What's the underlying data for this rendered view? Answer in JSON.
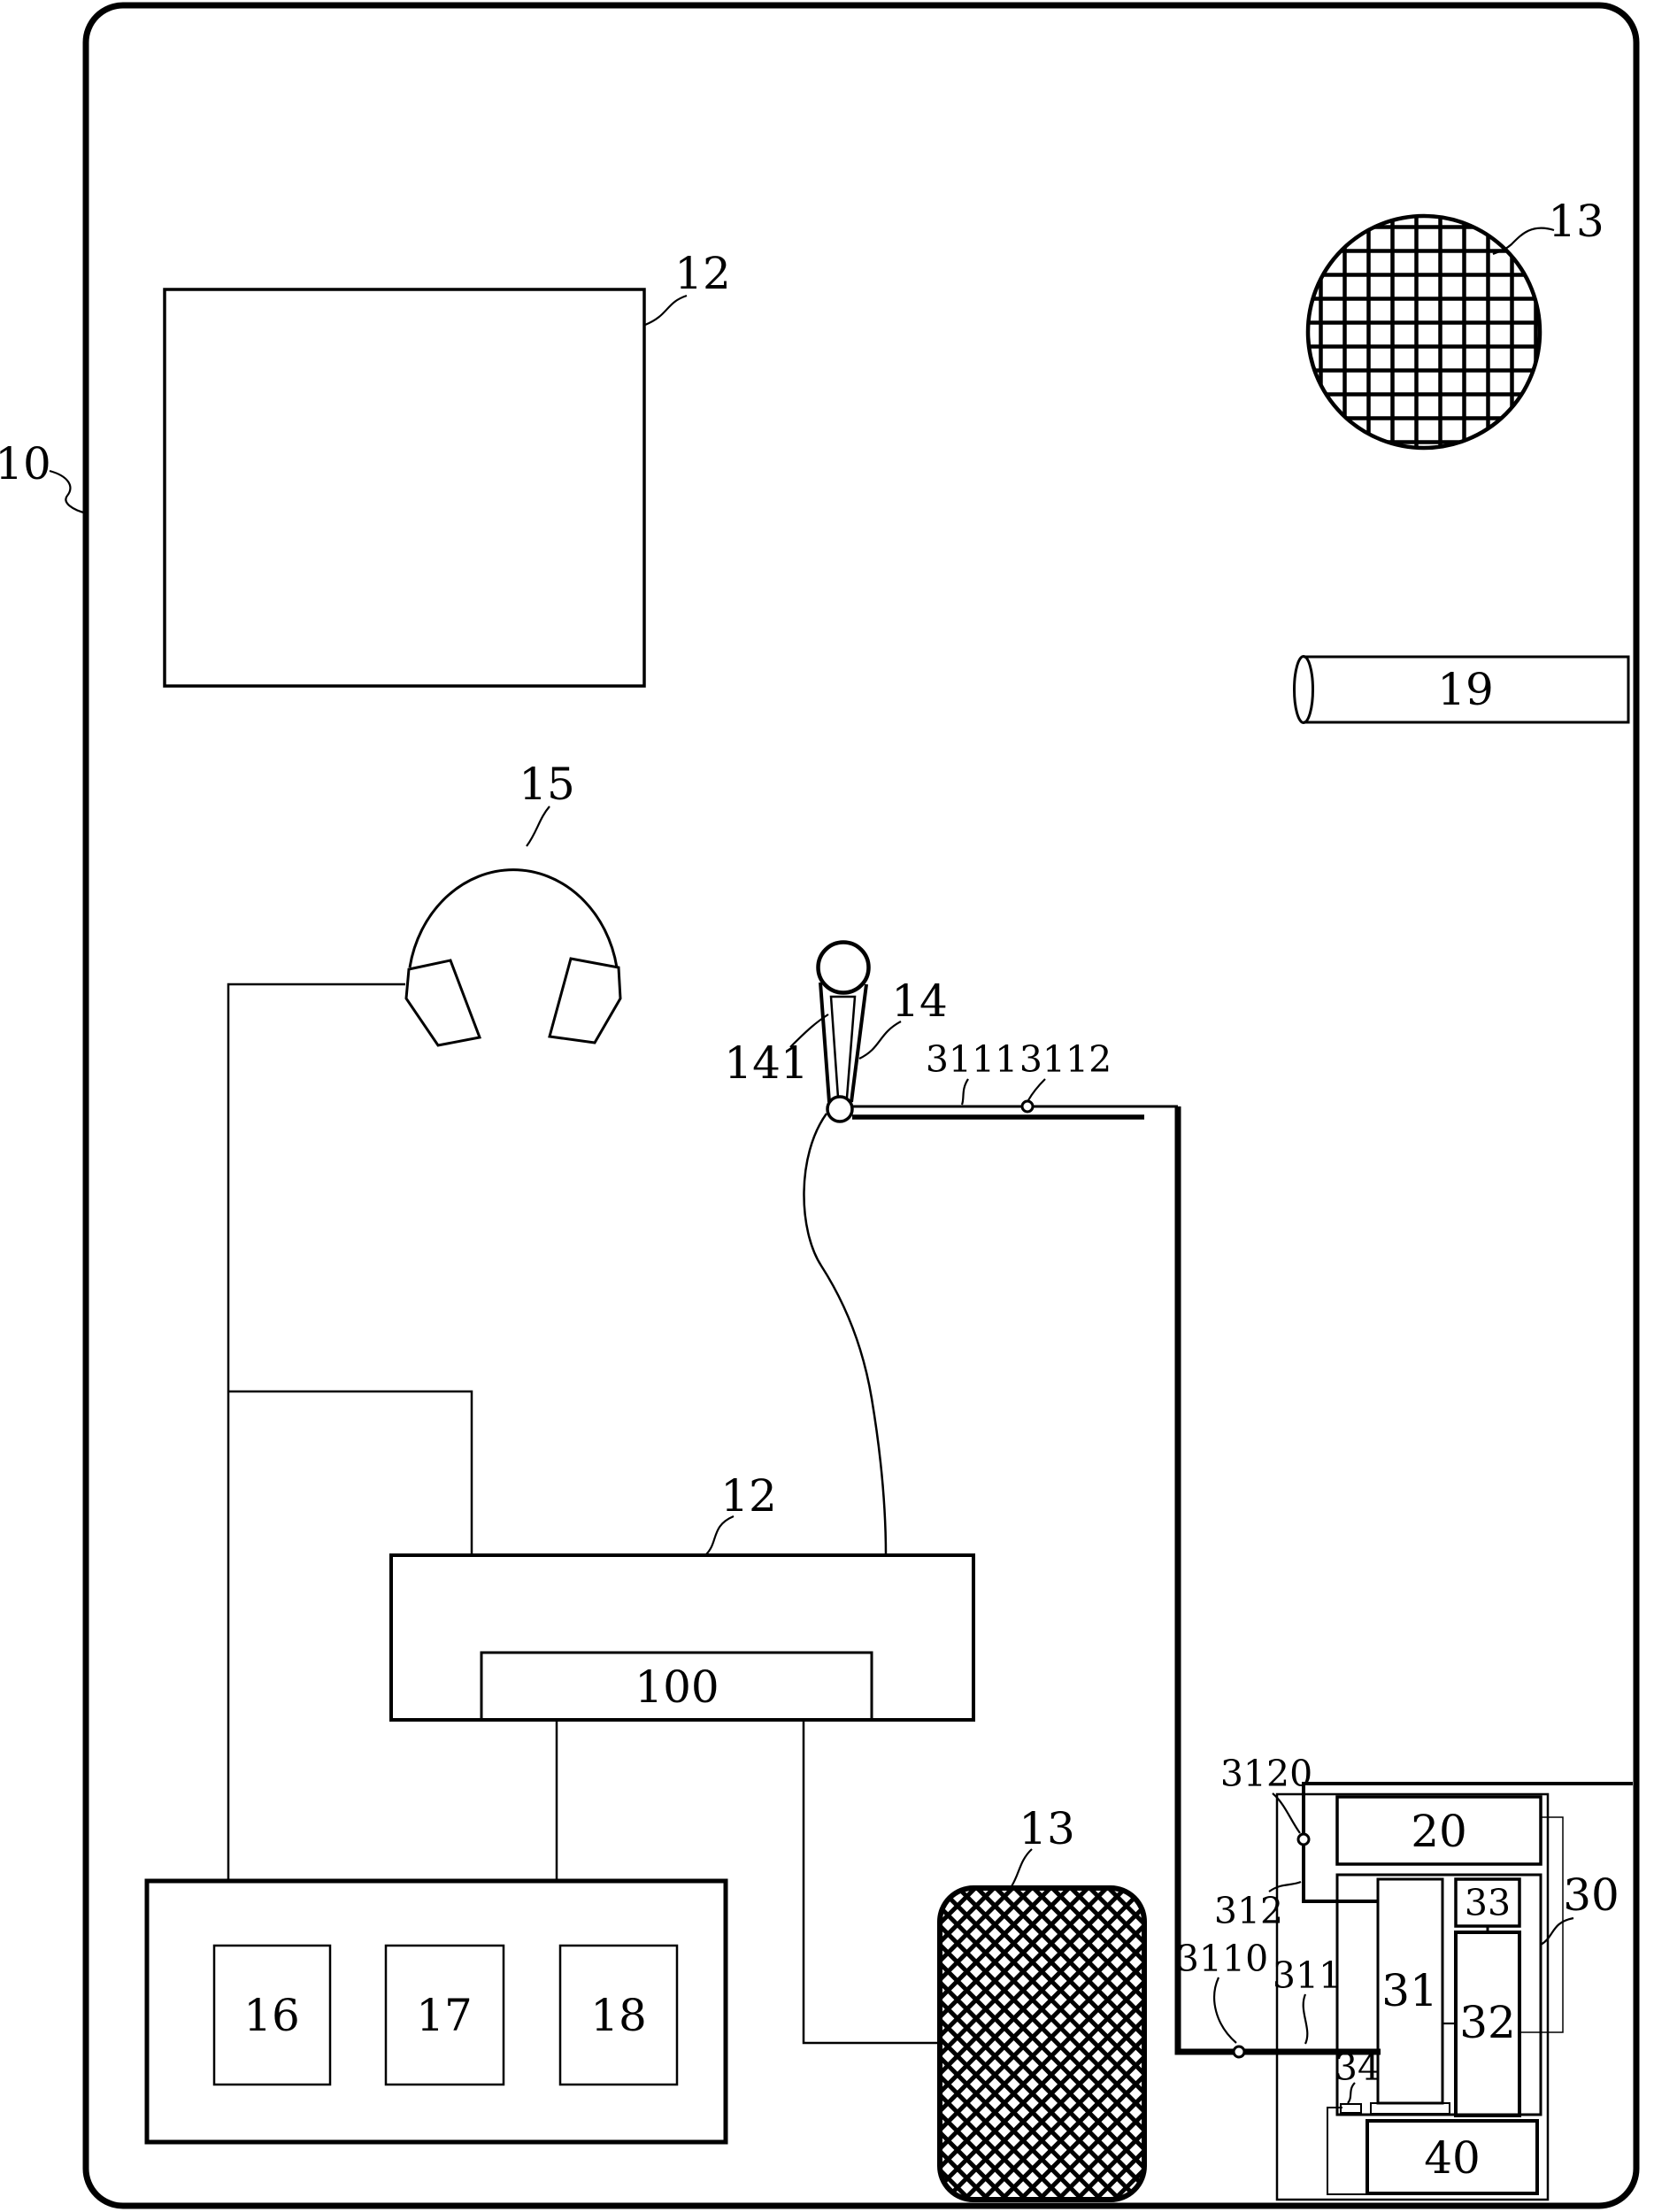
{
  "figure": {
    "type": "patent-line-drawing",
    "colors": {
      "ink": "#000000",
      "background": "#ffffff"
    },
    "labels": {
      "frame": "10",
      "panel_top_left": "12",
      "mesh_circle": "13",
      "cylinder": "19",
      "headphones": "15",
      "microphone": "14",
      "mic_handle": "141",
      "wire_thin": "3111",
      "wire_node_top": "3112",
      "panel_mid": "12",
      "panel_mid_inner": "100",
      "mesh_pad": "13",
      "box_16": "16",
      "box_17": "17",
      "box_18": "18",
      "node_3120": "3120",
      "box_20": "20",
      "wire_312": "312",
      "assembly_30": "30",
      "box_33": "33",
      "node_3110": "3110",
      "wire_311": "311",
      "box_31": "31",
      "box_32": "32",
      "box_34": "34",
      "box_40": "40"
    }
  }
}
